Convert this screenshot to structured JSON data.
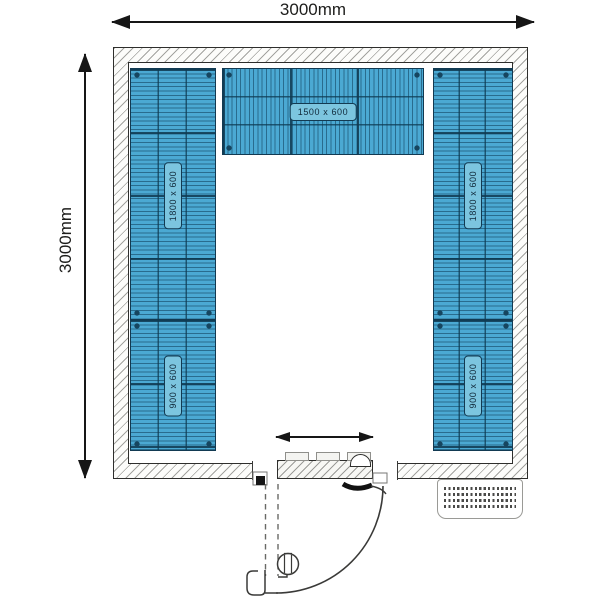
{
  "dimensions": {
    "width": "3000mm",
    "height": "3000mm"
  },
  "shelves": {
    "top": {
      "label": "1500 x 600"
    },
    "left_upper": {
      "label": "1800 x 600"
    },
    "left_lower": {
      "label": "900 x 600"
    },
    "right_upper": {
      "label": "1800 x 600"
    },
    "right_lower": {
      "label": "900 x 600"
    }
  },
  "colors": {
    "shelf_fill": "#4ba9d3",
    "shelf_wire_line": "#0d3a55",
    "shelf_border": "#123a52",
    "shelf_label_fill": "#7cc5df",
    "wall_hatch": "#5a5a55",
    "outline": "#2e2e2c",
    "background": "#ffffff"
  }
}
